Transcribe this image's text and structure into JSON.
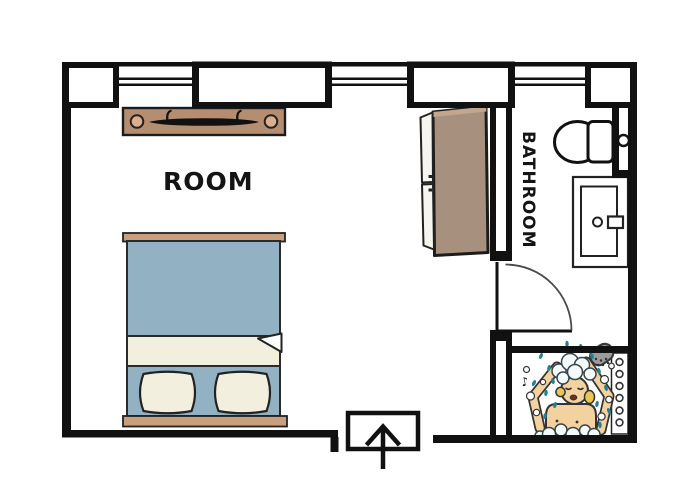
{
  "labels": {
    "room": "ROOM",
    "bathroom": "BATHROOM"
  },
  "icons": {
    "music_note": "♪"
  },
  "colors": {
    "wall": "#111111",
    "bed_blanket": "#92b2c3",
    "linen": "#f3efdf",
    "bed_frame": "#c9a07d",
    "shelf": "#b58d71",
    "shelf_bracket": "#dcae8d",
    "wardrobe": "#a8907e",
    "wardrobe_door": "#f7f5ef",
    "skin": "#f3d2a0",
    "hair": "#e9c554",
    "water": "#26808f",
    "shower_head": "#9b9b9b"
  },
  "elements": [
    "outer walls with window piers",
    "three windows on top wall",
    "window-side shelf with rail",
    "double bed with folded sheet and two pillows",
    "wardrobe with open doors",
    "interior door with swing arc",
    "toilet with tank",
    "sink vanity with faucet",
    "shower with shower head and person washing",
    "entrance with up arrow"
  ]
}
